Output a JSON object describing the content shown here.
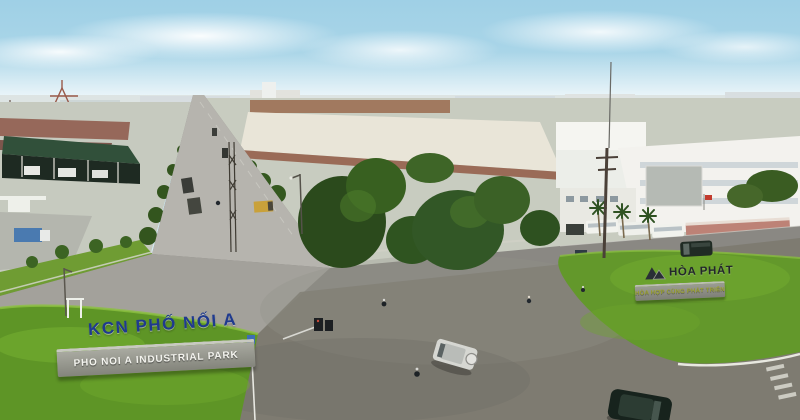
{
  "meta": {
    "title": "Aerial view of Pho Noi A Industrial Park road intersection",
    "description": "Wide asphalt three-way junction with manicured green lawns, entrance signs, factories, tree lines and light traffic under a hazy blue sky"
  },
  "signs": {
    "kcn": {
      "letters": "KCN PHỐ NỐI A",
      "stone": "PHO NOI A INDUSTRIAL PARK"
    },
    "hoa_phat": {
      "brand": "HÒA PHÁT",
      "tagline": "HÒA HỢP CÙNG PHÁT TRIỂN"
    }
  },
  "colors": {
    "sky_top": "#9fd0e6",
    "sky_horizon": "#eef5f6",
    "grass": "#5f9427",
    "grass_light": "#7cb535",
    "asphalt": "#8a8883",
    "asphalt_dark": "#6f6d66",
    "avenue_far": "#b6b4ae",
    "sign_navy": "#1f3a8e",
    "stone_gray": "#8f9086",
    "stone_text": "#f4f4ef",
    "hoa_phat_dark": "#23272c",
    "tagline_green": "#99a02e",
    "tree_dark": "#2b4a1c",
    "roof_red": "#96685a",
    "warehouse_green": "#31503a",
    "building_white": "#f3f2ee",
    "gate_pink": "#bd8276",
    "distant_blue_roof": "#5b86b8"
  }
}
